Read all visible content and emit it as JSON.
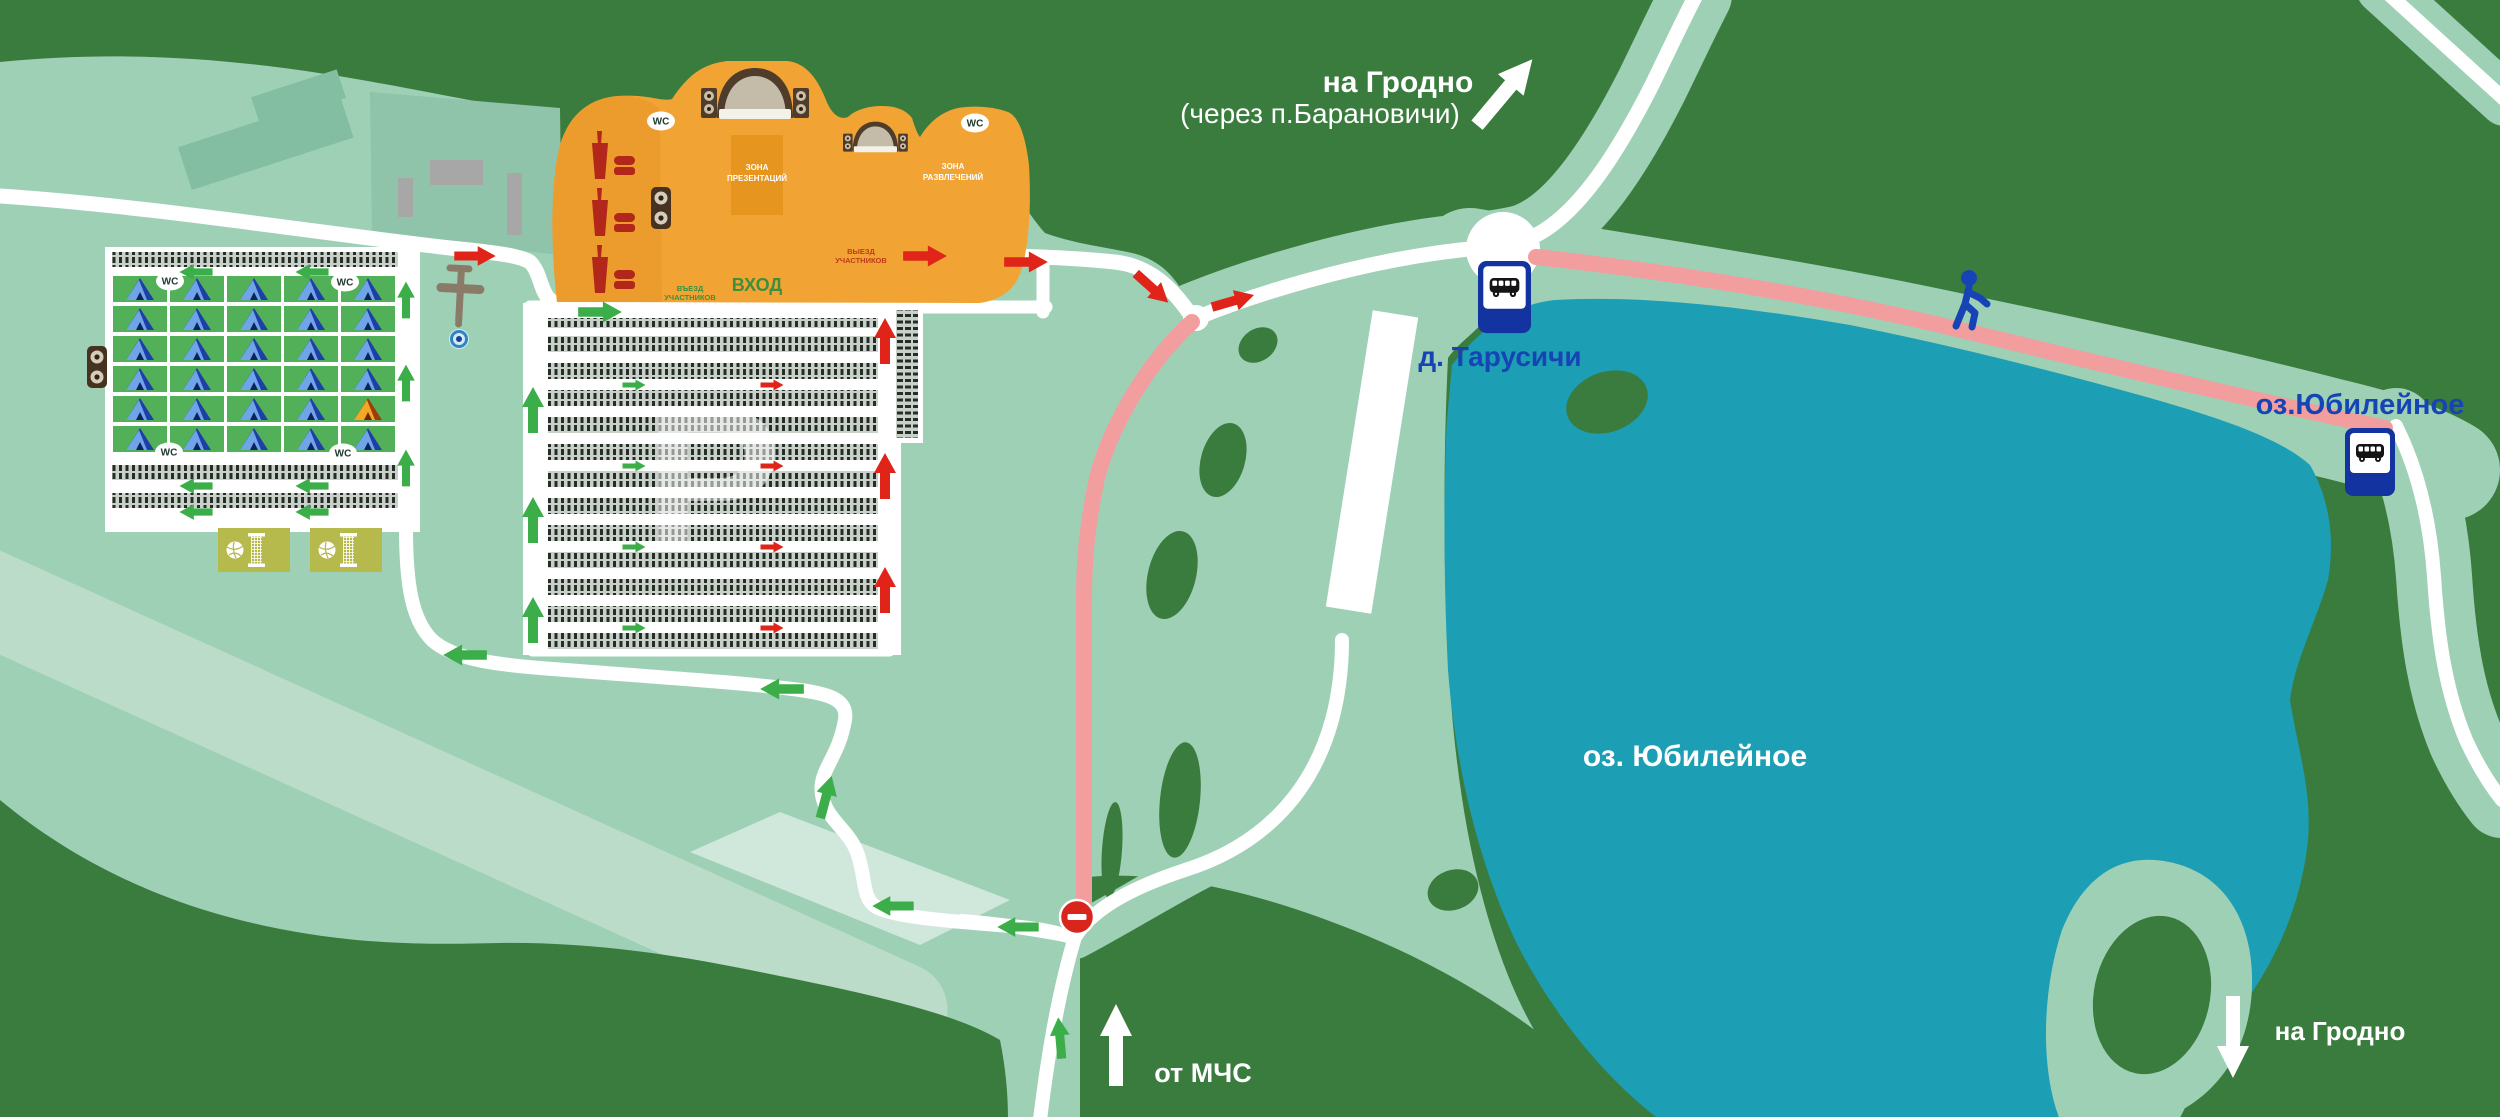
{
  "labels": {
    "route_top_right_line1": "на Гродно",
    "route_top_right_line2": "(через п.Барановичи)",
    "village_stop": "д. Тарусичи",
    "lake_stop": "оз.Юбилейное",
    "lake_name": "оз. Юбилейное",
    "route_bottom_right": "на Гродно",
    "route_bottom_center": "от МЧС",
    "presentation_zone_line1": "ЗОНА",
    "presentation_zone_line2": "ПРЕЗЕНТАЦИЙ",
    "entertainment_zone_line1": "ЗОНА",
    "entertainment_zone_line2": "РАЗВЛЕЧЕНИЙ",
    "entrance": "ВХОД",
    "participants_entry_line1": "ВЪЕЗД",
    "participants_entry_line2": "УЧАСТНИКОВ",
    "participants_exit_line1": "ВЫЕЗД",
    "participants_exit_line2": "УЧАСТНИКОВ",
    "wc": "WC",
    "parking_letter": "Р"
  },
  "colors": {
    "forest": "#3A7C3E",
    "field": "#9ED0B6",
    "field_shade": "#8FC4AA",
    "field_light": "#BBDCC9",
    "road": "#FFFFFF",
    "lake": "#1C9EB4",
    "walking_route_pink": "#F29E9E",
    "venue_orange": "#F1A434",
    "venue_orange_inner": "#E6951E",
    "camp_cell_green": "#52B058",
    "court_olive": "#B6B94B",
    "entry_arrow_green": "#3BAE4A",
    "exit_arrow_red": "#E0241A",
    "bus_sign_blue": "#1233A0",
    "label_blue": "#1744B5",
    "food_icon_red": "#B3261A"
  },
  "icons": {
    "tent-icon": "triangle tent pictogram (blue, one orange)",
    "bus-stop-icon": "black bus in white square on blue sign",
    "stage-icon": "arched stage with speaker stacks",
    "speaker-icon": "amplifier with two round speakers",
    "food-court-icon": "drink cup and burger",
    "volleyball-court-icon": "volleyball and net on olive court",
    "walking-person-icon": "blue pedestrian figure",
    "no-entry-icon": "red circle with white bar",
    "airplane-icon": "small plane silhouette",
    "viewpoint-icon": "blue concentric circles",
    "wc-icon": "WC oval badge",
    "entry-arrow-icon": "green arrow",
    "exit-arrow-icon": "red arrow",
    "direction-arrow-icon": "large white arrow"
  }
}
